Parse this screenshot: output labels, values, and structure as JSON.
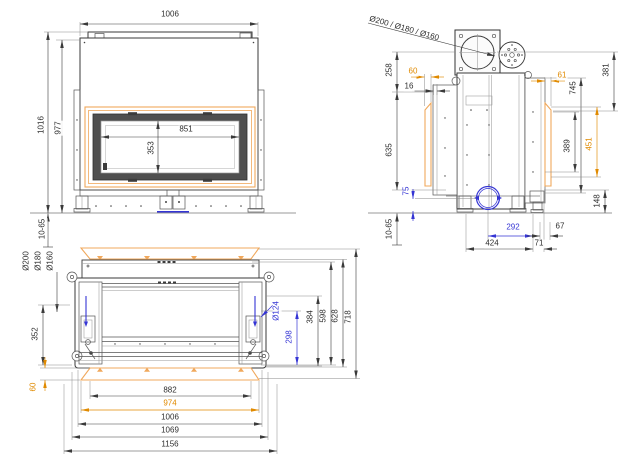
{
  "colors": {
    "ink": "#3a3a3a",
    "orange_text": "#e08a00",
    "orange_line": "#f0a85c",
    "blue": "#3434d4"
  },
  "front_view": {
    "label": "front-view",
    "dims": {
      "overall_width": "1006",
      "overall_height": "1016",
      "body_height": "977",
      "glass_width": "851",
      "glass_height": "353",
      "foot_range": "10-65"
    }
  },
  "side_view": {
    "label": "side-view",
    "flue_diameters": "Ø200 / Ø180 / Ø160",
    "dims": {
      "flue_center_height": "258",
      "frame_depth_front": "60",
      "gap_16": "16",
      "frame_depth_rear": "61",
      "body_height_745": "745",
      "top_section_381": "381",
      "front_height_635": "635",
      "rear_section_389": "389",
      "frame_height_451": "451",
      "outlet_height_75": "75",
      "base_height_148": "148",
      "foot_range": "10-65",
      "outlet_offset_292": "292",
      "rear_offset_67": "67",
      "base_depth_424": "424",
      "rear_bracket_71": "71"
    }
  },
  "plan_view": {
    "label": "top-view",
    "flue_diameters": [
      "Ø200",
      "Ø180",
      "Ø160"
    ],
    "dims": {
      "flue_offset_352": "352",
      "frame_height_60": "60",
      "outlet_diameter": "Ø124",
      "outlet_offset_298": "298",
      "depth_384": "384",
      "depth_598": "598",
      "depth_628": "628",
      "depth_718": "718",
      "width_882": "882",
      "width_974": "974",
      "width_1006": "1006",
      "width_1069": "1069",
      "width_1156": "1156"
    }
  }
}
